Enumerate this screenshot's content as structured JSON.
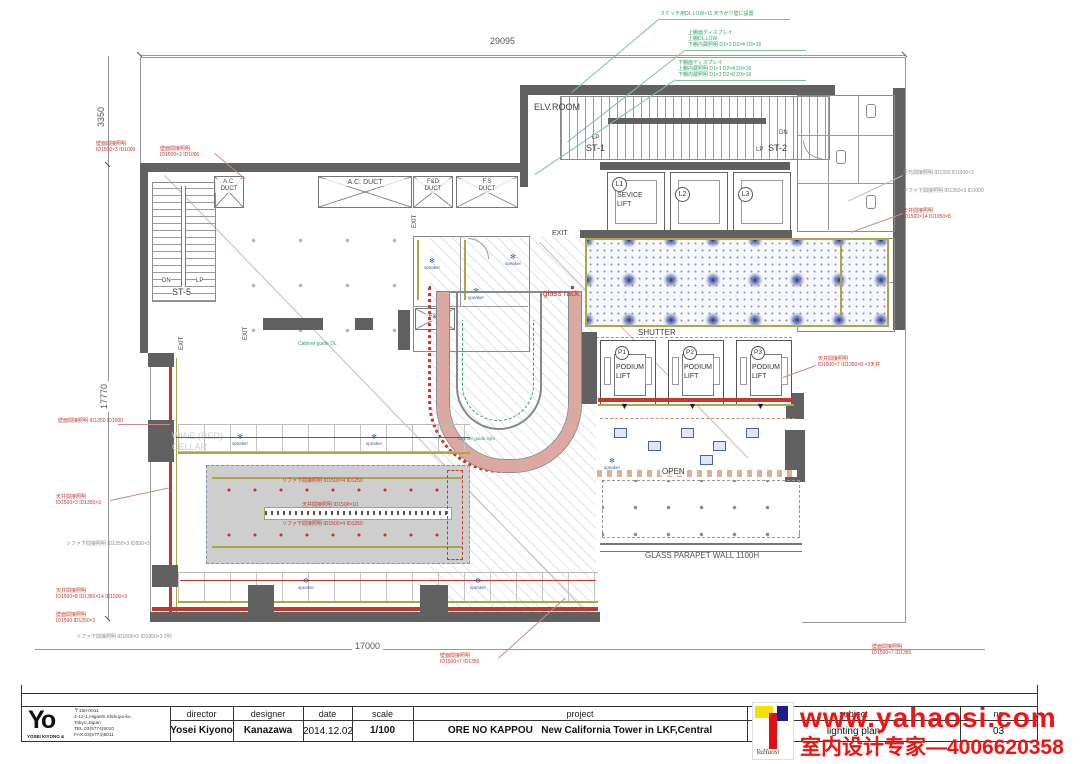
{
  "colors": {
    "accent_red": "#c0392b",
    "olive": "#a8a848",
    "carpet_blue": "#5b6bae",
    "annotation_green": "#2f9e63",
    "watermark_red": "#f21212",
    "wall_gray": "#616161"
  },
  "dims": {
    "top": "29095",
    "left_upper": "3350",
    "left_main": "17770",
    "bottom": "17000"
  },
  "rooms": {
    "elv": "ELV.ROOM",
    "st1": "ST-1",
    "st2": "ST-2",
    "st5": "ST-5",
    "lp": "LP",
    "dn": "DN",
    "ac1": "A.C.",
    "duct": "DUCT",
    "fd": "F&D",
    "fs": "F.S",
    "exit": "EXIT",
    "l1": "L1",
    "l2": "L2",
    "l3": "L3",
    "sevice1": "SEVICE",
    "sevice2": "LIFT",
    "shutter": "SHUTTER",
    "p1": "P1",
    "p2": "P2",
    "p3": "P3",
    "podium1": "PODIUM",
    "podium2": "LIFT",
    "fd_room": "F&D",
    "glass_rack": "glass rack",
    "wine1": "WINE (RED)",
    "wine2": "CELLAR",
    "open": "OPEN",
    "parapet": "GLASS PARAPET WALL 1100H",
    "speaker": "speaker"
  },
  "annotations": {
    "a1": "スケッチ用DL.LOW×11 天下がり壁に設置",
    "a2": "上棚面ディスプレイ\n上棚DL.LOW\n下棚内蔵照明 D1×3 D2×4 D3×16",
    "a3": "下棚面ディスプレイ\n上棚内蔵照明 D1×1 D2×4 D3×16\n下棚内蔵照明 D1×3 D2×8 D3×16",
    "a4": "壁面間接照明\nID1500×3 ID1000",
    "a5": "足元間接照明 ID1350 ID1000×3",
    "a6": "ソファ下間接照明 ID1350×3 ID1000",
    "a7": "天井間接照明\nID1500×14 ID1050×8",
    "a8": "壁面間接照明 ID1350 ID1000",
    "a9": "天井間接照明\nID1500×3 ID1350×3",
    "a10": "ソファ下間接照明 ID1350×3 ID500×3",
    "a11": "天井間接照明\nID1500×8 ID1350×14 ID1500×3",
    "a12": "壁面間接照明\nID1500 ID1350×2",
    "a13": "ソファ下間接照明 ID1500×3 ID1950×3 3列",
    "a14": "壁面間接照明\nID1500×7 ID1350",
    "a15": "天井間接照明\nID1500×7 ID1350×8 ×3天井",
    "a16": "ソファ下間接照明 ID1500×4 ID1250",
    "a17": "天井間接照明 ID1500×10",
    "a18": "Cabinet guide DL",
    "a19": "counter guide light"
  },
  "title_block": {
    "logo_mark": "Yo",
    "logo_sub": "YOSEI KIYONO &",
    "address_zip": "〒150-0011",
    "address_1": "4-12-1,Higashi,Shibuya-ku,",
    "address_2": "Tokyo,Japan",
    "address_3": "TEL.03(5774)5010",
    "address_4": "FAX.03(5774)5011",
    "director_label": "director",
    "director": "Yosei Kiyono",
    "designer_label": "designer",
    "designer": "Kanazawa",
    "date_label": "date",
    "date": "2014.12.02",
    "scale_label": "scale",
    "scale": "1/100",
    "project_label": "project",
    "project": "ORE NO KAPPOU   New California Tower in LKF,Central",
    "subject_label": "subject",
    "subject": "lighting plan",
    "no_label": "no",
    "no": "03"
  },
  "watermark": {
    "url": "www.yahaosi.com",
    "phone": "室内设计专家—4006620358",
    "logo_script": "YaHaosi"
  }
}
